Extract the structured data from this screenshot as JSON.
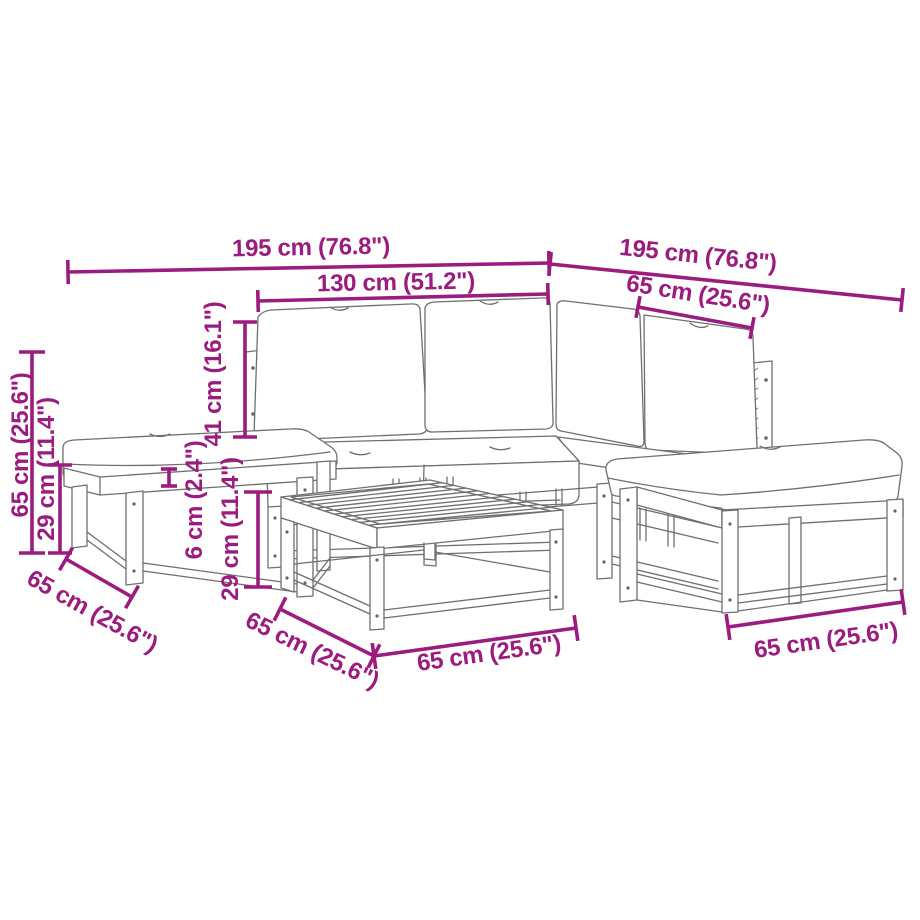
{
  "canvas": {
    "width": 920,
    "height": 920,
    "background": "#ffffff"
  },
  "style": {
    "dimension_color": "#9B1B7E",
    "line_art_color": "#6f6f6f",
    "dimension_line_width": 3.6,
    "line_art_width": 1.3
  },
  "diagram": {
    "type": "furniture-dimension-diagram",
    "pieces": [
      "corner-sofa-modules",
      "left-footstool",
      "right-footstool",
      "slatted-coffee-table"
    ]
  },
  "dimensions": [
    {
      "id": "overall-width-left",
      "text": "195 cm (76.8\")",
      "line": {
        "x1": 68,
        "y1": 272,
        "x2": 549,
        "y2": 263
      },
      "tick": 24,
      "label": {
        "x": 311,
        "y": 248,
        "rot": -1
      }
    },
    {
      "id": "sofa-width",
      "text": "130 cm (51.2\")",
      "line": {
        "x1": 258,
        "y1": 301,
        "x2": 548,
        "y2": 294
      },
      "tick": 22,
      "label": {
        "x": 396,
        "y": 283,
        "rot": -1
      }
    },
    {
      "id": "overall-width-right",
      "text": "195 cm (76.8\")",
      "line": {
        "x1": 550,
        "y1": 264,
        "x2": 902,
        "y2": 300
      },
      "tick": 24,
      "label": {
        "x": 698,
        "y": 256,
        "rot": 6
      }
    },
    {
      "id": "module-width-top",
      "text": "65 cm (25.6\")",
      "line": {
        "x1": 638,
        "y1": 307,
        "x2": 752,
        "y2": 328
      },
      "tick": 22,
      "label": {
        "x": 698,
        "y": 295,
        "rot": 9
      }
    },
    {
      "id": "overall-height",
      "text": "65 cm (25.6\")",
      "line": {
        "x1": 32,
        "y1": 352,
        "x2": 32,
        "y2": 553
      },
      "tick": 26,
      "label": {
        "x": 21,
        "y": 445,
        "rot": -90
      }
    },
    {
      "id": "seat-height-left",
      "text": "29 cm (11.4\")",
      "line": {
        "x1": 60,
        "y1": 465,
        "x2": 60,
        "y2": 553
      },
      "tick": 24,
      "label": {
        "x": 47,
        "y": 469,
        "rot": -90
      }
    },
    {
      "id": "backrest-height",
      "text": "41 cm (16.1\")",
      "line": {
        "x1": 245,
        "y1": 322,
        "x2": 245,
        "y2": 437
      },
      "tick": 24,
      "label": {
        "x": 214,
        "y": 374,
        "rot": -90
      }
    },
    {
      "id": "cushion-thickness",
      "text": "6 cm (2.4\")",
      "line": {
        "x1": 169,
        "y1": 469,
        "x2": 169,
        "y2": 486
      },
      "tick": 16,
      "label": {
        "x": 195,
        "y": 500,
        "rot": -90
      }
    },
    {
      "id": "seat-height-mid",
      "text": "29 cm (11.4\")",
      "line": {
        "x1": 258,
        "y1": 492,
        "x2": 258,
        "y2": 587
      },
      "tick": 28,
      "label": {
        "x": 231,
        "y": 529,
        "rot": -90
      }
    },
    {
      "id": "stool-depth-left",
      "text": "65 cm (25.6\")",
      "line": {
        "x1": 66,
        "y1": 559,
        "x2": 132,
        "y2": 597
      },
      "tick": 26,
      "label": {
        "x": 92,
        "y": 612,
        "rot": 29
      }
    },
    {
      "id": "table-depth",
      "text": "65 cm (25.6\")",
      "line": {
        "x1": 280,
        "y1": 609,
        "x2": 374,
        "y2": 656
      },
      "tick": 26,
      "label": {
        "x": 312,
        "y": 651,
        "rot": 26
      }
    },
    {
      "id": "table-width",
      "text": "65 cm (25.6\")",
      "line": {
        "x1": 374,
        "y1": 656,
        "x2": 576,
        "y2": 628
      },
      "tick": 26,
      "label": {
        "x": 489,
        "y": 654,
        "rot": -8
      }
    },
    {
      "id": "stool-width-right",
      "text": "65 cm (25.6\")",
      "line": {
        "x1": 728,
        "y1": 627,
        "x2": 903,
        "y2": 602
      },
      "tick": 26,
      "label": {
        "x": 826,
        "y": 641,
        "rot": -8
      }
    }
  ]
}
